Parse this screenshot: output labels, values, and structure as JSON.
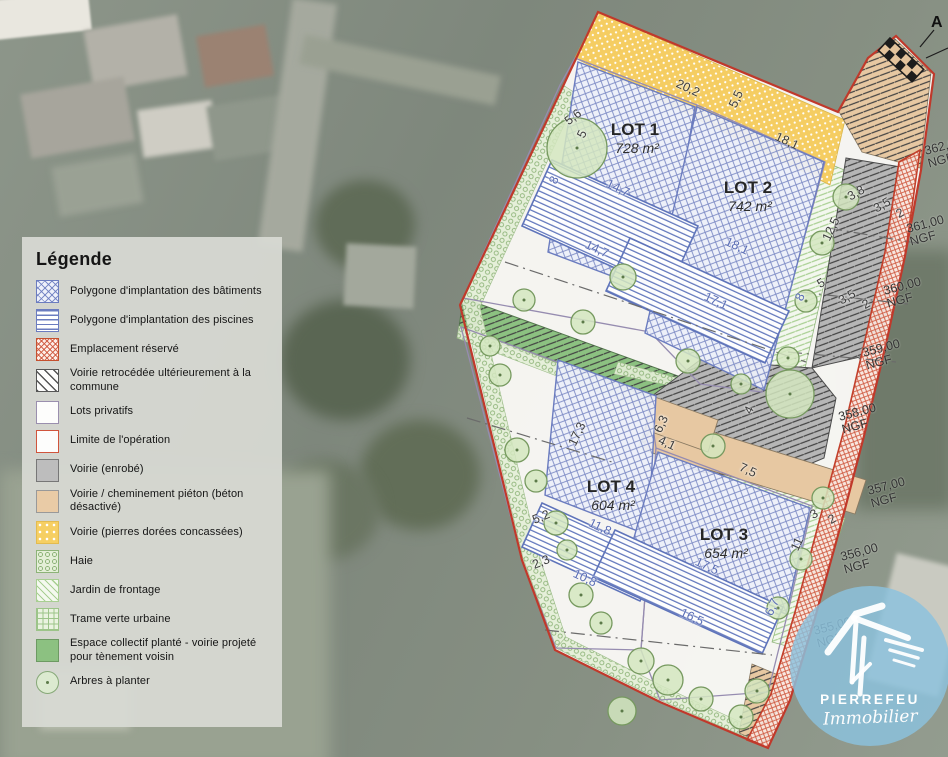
{
  "legend": {
    "title": "Légende",
    "items": [
      {
        "label": "Polygone d'implantation des bâtiments",
        "swatch": "batiments"
      },
      {
        "label": "Polygone d'implantation des piscines",
        "swatch": "piscines"
      },
      {
        "label": "Emplacement réservé",
        "swatch": "reserve"
      },
      {
        "label": "Voirie retrocédée ultérieurement à la commune",
        "swatch": "retro"
      },
      {
        "label": "Lots privatifs",
        "swatch": "lots"
      },
      {
        "label": "Limite de l'opération",
        "swatch": "limite"
      },
      {
        "label": "Voirie (enrobé)",
        "swatch": "enrobe"
      },
      {
        "label": "Voirie / cheminement piéton (béton désactivé)",
        "swatch": "pieton"
      },
      {
        "label": "Voirie (pierres dorées concassées)",
        "swatch": "pierres"
      },
      {
        "label": "Haie",
        "swatch": "haie"
      },
      {
        "label": "Jardin de frontage",
        "swatch": "jardin"
      },
      {
        "label": "Trame verte urbaine",
        "swatch": "trame"
      },
      {
        "label": "Espace collectif planté - voirie projeté pour tènement voisin",
        "swatch": "espace"
      },
      {
        "label": "Arbres à planter",
        "swatch": "arbres"
      }
    ]
  },
  "plan": {
    "lots": [
      {
        "name": "LOT 1",
        "area": "728 m²"
      },
      {
        "name": "LOT 2",
        "area": "742 m²"
      },
      {
        "name": "LOT 4",
        "area": "604 m²"
      },
      {
        "name": "LOT 3",
        "area": "654 m²"
      }
    ],
    "dimensions": [
      "20,2",
      "5,5",
      "18,1",
      "5,6",
      "5",
      "8",
      "14,7",
      "14,7",
      "18,1",
      "17,1",
      "8",
      "5",
      "3,5",
      "2",
      "3,8",
      "3,5",
      "2",
      "12,5",
      "4",
      "6,3",
      "4,1",
      "7,5",
      "17,3",
      "5,2",
      "2,3",
      "11,8",
      "10,8",
      "17,5",
      "16,5",
      "6,7",
      "11",
      "3",
      "2"
    ],
    "elevations": [
      "362,00",
      "361,00",
      "360,00",
      "359,00",
      "358,00",
      "357,00",
      "356,00",
      "355,00"
    ],
    "elevation_unit": "NGF",
    "section_marker": "A"
  },
  "logo": {
    "brand": "PIERREFEU",
    "tagline": "Immobilier"
  },
  "colors": {
    "limite_red": "#c0392b",
    "implantation_blue": "#6b7cbf",
    "espace_green": "#8cc181",
    "pierres_yellow": "#f6cf63",
    "pieton_tan": "#e7c8a2",
    "logo_blue": "#8cc2dd"
  }
}
